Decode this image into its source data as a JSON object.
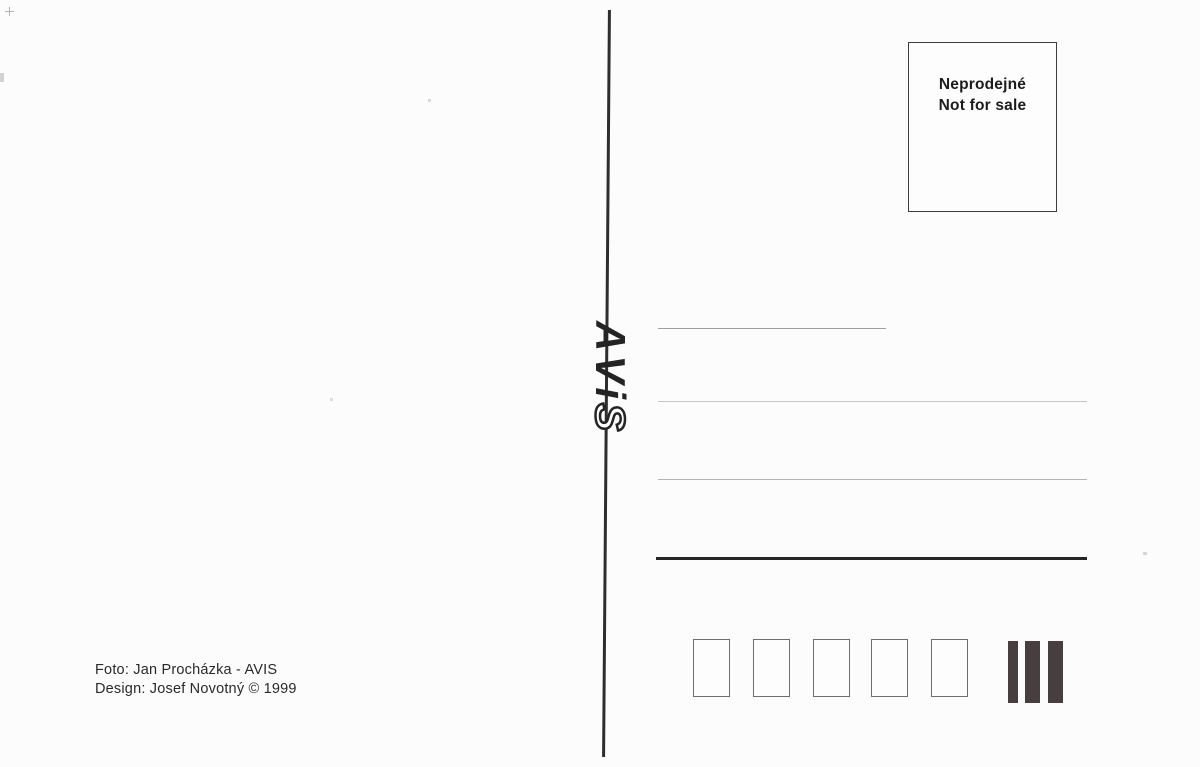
{
  "meta": {
    "kind": "postcard-back-scan",
    "publisher": "AVIS"
  },
  "colors": {
    "background": "#fcfcfc",
    "ink": "#262626",
    "divider": "#2e2e2e",
    "address_line_light": "#b4b4b4",
    "sorting_bar": "#473f3f",
    "postal_box_border": "#6e6e6e"
  },
  "stamp_box": {
    "line1": "Neprodejné",
    "line2": "Not for sale"
  },
  "logo": {
    "name": "AViS",
    "chars": [
      "A",
      "V",
      "i",
      "S"
    ],
    "rotation_deg": 90
  },
  "address": {
    "thin_line_count": 3,
    "thick_line_count": 1
  },
  "postal_code_boxes": {
    "count": 5
  },
  "sorting_bars": {
    "count": 3
  },
  "credits": {
    "line1": "Foto: Jan Procházka - AVIS",
    "line2": "Design: Josef Novotný © 1999"
  }
}
